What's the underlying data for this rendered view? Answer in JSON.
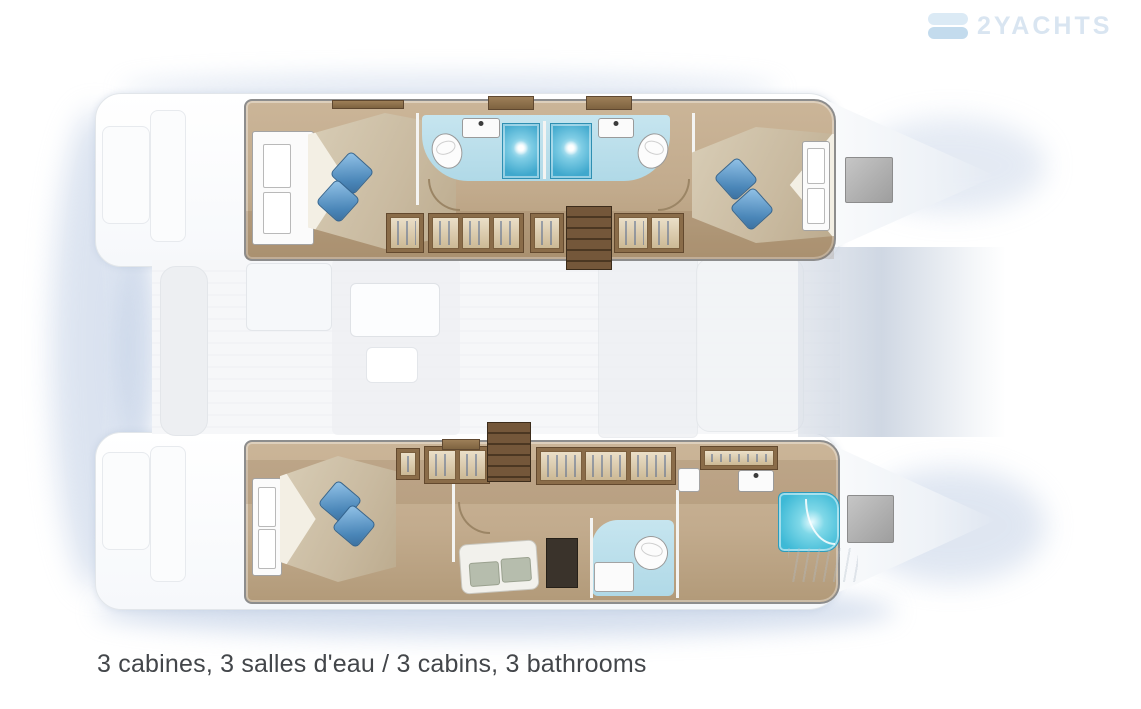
{
  "caption": {
    "text": "3 cabines, 3 salles d'eau / 3 cabins, 3 bathrooms"
  },
  "watermark": {
    "text": "2YACHTS"
  },
  "floorplan": {
    "type": "catamaran-deck-plan",
    "hulls": [
      {
        "id": "starboard-hull",
        "position": "top",
        "features": [
          "aft-double-cabin",
          "aft-bathroom-with-shower",
          "forward-bathroom-with-shower",
          "wardrobes",
          "companionway-stairs",
          "forward-double-cabin",
          "bow-deck-hatch"
        ]
      },
      {
        "id": "port-hull",
        "position": "bottom",
        "features": [
          "aft-owner-cabin",
          "wardrobes",
          "companionway-stairs",
          "vanity-desk-with-seat",
          "owner-bathroom",
          "separate-large-shower",
          "bow-deck-hatch"
        ]
      }
    ],
    "bridgedeck": "ghosted-saloon-cockpit-and-foredeck",
    "colors": {
      "wood": "#c2ab8d",
      "wood-dark": "#8a6c49",
      "stair-light": "#74573a",
      "stair-dark": "#4b3722",
      "mattress": "#c9baa0",
      "pillow-light": "#93c3e8",
      "pillow-dark": "#3b6f9e",
      "bath-floor": "#b0d9e7",
      "shower": "#3fa8cd",
      "shower-big": "#3db9d6",
      "fixture": "#fbfbfb",
      "line": "#8d8d8d",
      "hatch-gray": "#9e9e9e",
      "ghost": "#edeff2",
      "ghost-line": "#e3e6ea",
      "shadow": "#b9c9e2",
      "deck-edge": "#e2e6ea",
      "caption": "#43464a",
      "watermark": "#d5e3f0"
    }
  }
}
